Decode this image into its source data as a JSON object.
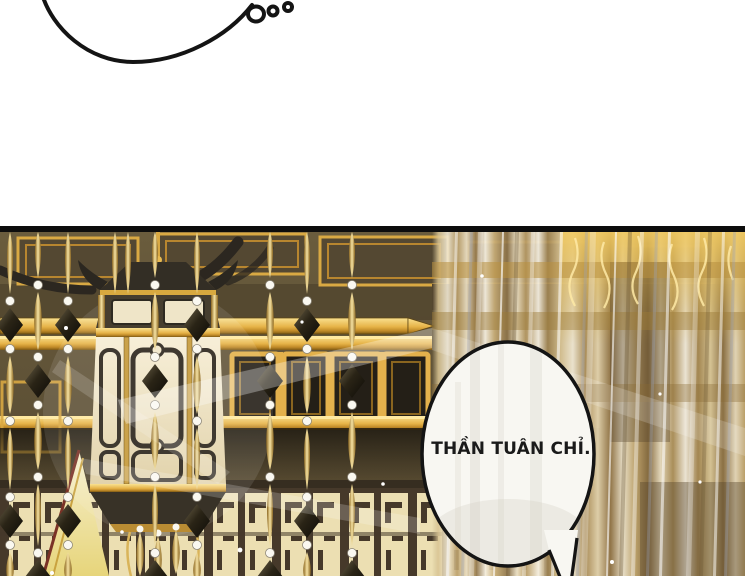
{
  "comic": {
    "speech_bubble": {
      "text": "THẦN TUÂN CHỈ."
    },
    "colors": {
      "page-bg": "#ffffff",
      "ink": "#141414",
      "panel-border": "#0d0d0d",
      "bubble-fill": "#f8f7f2",
      "bubble-text": "#1a1a1a",
      "hall-bg": "#5e5136",
      "gold": "#e2ae45",
      "gold-light": "#f7df95",
      "gold-deep": "#8a651f",
      "wood-dark": "#322c22",
      "cream": "#f1e7ca",
      "lattice-ink": "#46392a",
      "curtain-tan": "#cbaa68",
      "curtain-white": "#f4efe4",
      "curtain-blue": "#a9b0bf"
    }
  }
}
